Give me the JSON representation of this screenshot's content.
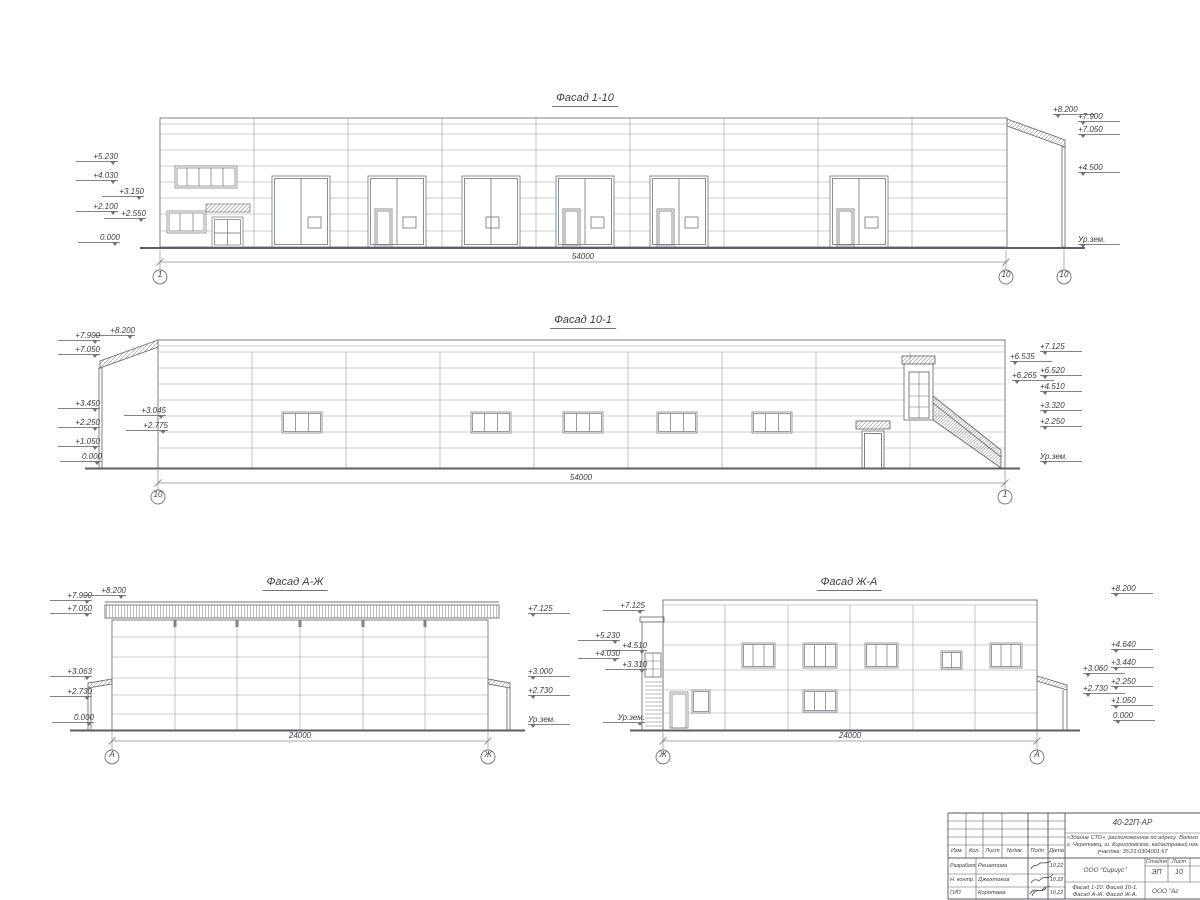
{
  "sheet": {
    "type": "Архитектурные фасады",
    "accent_line_color": "#6e747b",
    "panel_line_color": "#9aa0a5",
    "ground_line_color": "#5a5f66"
  },
  "facades": [
    {
      "title": "Фасад 1-10",
      "dimension": "54000",
      "axes": [
        "1",
        "10",
        "10"
      ],
      "marks_left": [
        "+5.230",
        "+4.030",
        "+3.150",
        "+2.100",
        "+2.550",
        "0.000"
      ],
      "marks_right": [
        "+8.200",
        "+7.900",
        "+7.050",
        "+4.500",
        "Ур.зем."
      ]
    },
    {
      "title": "Фасад 10-1",
      "dimension": "54000",
      "axes": [
        "10",
        "1"
      ],
      "marks_left": [
        "+8.200",
        "+7.900",
        "+7.050",
        "+3.450",
        "+3.045",
        "+2.775",
        "+2.250",
        "+1.050",
        "0.000"
      ],
      "marks_right": [
        "+7.125",
        "+6.535",
        "+6.520",
        "+6.265",
        "+4.510",
        "+3.320",
        "+2.250",
        "Ур.зем."
      ]
    },
    {
      "title": "Фасад А-Ж",
      "dimension": "24000",
      "axes": [
        "А",
        "Ж"
      ],
      "marks_left": [
        "+8.200",
        "+7.900",
        "+7.050",
        "+3.063",
        "+2.730",
        "0.000"
      ],
      "marks_right": [
        "+7.125",
        "+3.000",
        "+2.730",
        "Ур.зем."
      ]
    },
    {
      "title": "Фасад Ж-А",
      "dimension": "24000",
      "axes": [
        "Ж",
        "А"
      ],
      "marks_left": [
        "+7.125",
        "+5.230",
        "+4.510",
        "+4.030",
        "+3.310",
        "Ур.зем."
      ],
      "marks_right": [
        "+8.200",
        "+4.640",
        "+3.440",
        "+3.060",
        "+2.250",
        "+2.730",
        "+1.050",
        "0.000"
      ]
    }
  ],
  "title_block": {
    "doc_number": "40-22П-АР",
    "project_line1": "«Здание СТО», расположенное по адресу: Вологодская",
    "project_line2": "г. Череповец, ш. Кирилловское, кадастровый номер зем.",
    "project_line3": "участка: 35:21:0304001:67",
    "cols": {
      "izm": "Изм.",
      "kol": "Кол.",
      "list": "Лист",
      "ndok": "№док.",
      "podp": "Подп.",
      "data": "Дата"
    },
    "rows": [
      {
        "role": "Разработал",
        "name": "Решетова",
        "date": "10.22"
      },
      {
        "role": "Н. контр.",
        "name": "Джелтоков",
        "date": "10.22"
      },
      {
        "role": "ГИП",
        "name": "Коротаев",
        "date": "10.22"
      }
    ],
    "org": "ООО \"Сириус\"",
    "stage_label": "Стадия",
    "sheet_label": "Лист",
    "stage": "ЭП",
    "sheet": "10",
    "content_line1": "Фасад 1-10. Фасад 10-1.",
    "content_line2": "Фасад А-Ж. Фасад Ж-А.",
    "org2": "ООО \"Аг"
  }
}
